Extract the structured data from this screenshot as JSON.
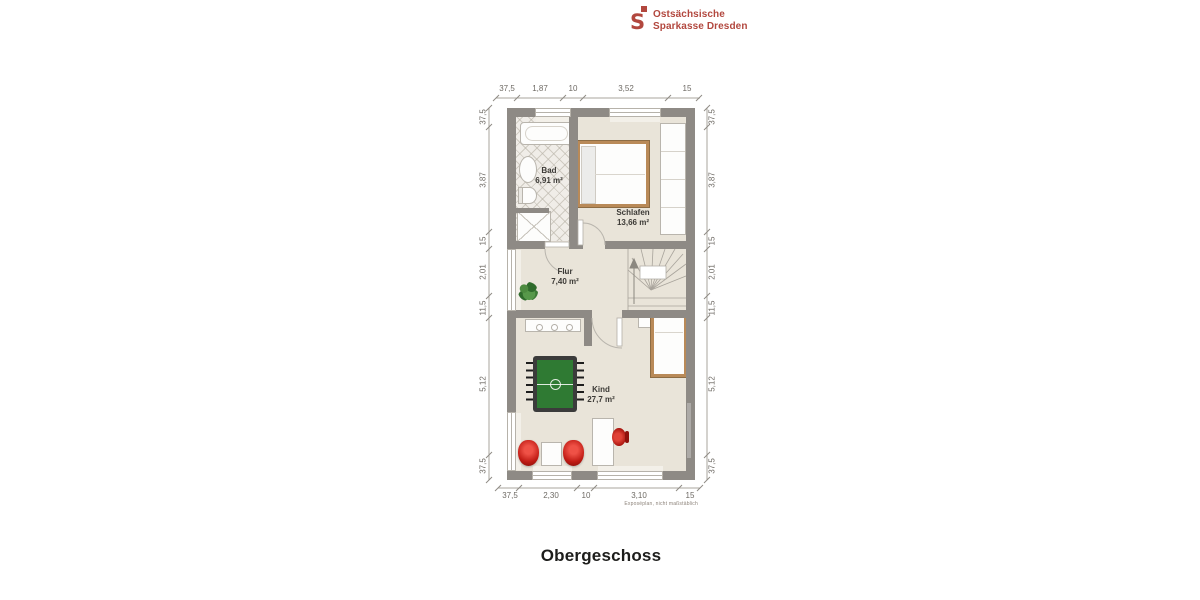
{
  "logo": {
    "icon_letter": "S",
    "name_line1": "Ostsächsische",
    "name_line2": "Sparkasse Dresden"
  },
  "plan": {
    "title": "Obergeschoss",
    "disclaimer": "Exposéplan, nicht maßstäblich",
    "rooms": [
      {
        "name": "Bad",
        "area": "6,91 m²"
      },
      {
        "name": "Schlafen",
        "area": "13,66 m²"
      },
      {
        "name": "Flur",
        "area": "7,40 m²"
      },
      {
        "name": "Kind",
        "area": "27,7 m²"
      }
    ],
    "dimensions": {
      "top": [
        "37,5",
        "1,87",
        "10",
        "3,52",
        "15"
      ],
      "bottom": [
        "37,5",
        "2,30",
        "10",
        "3,10",
        "15"
      ],
      "left": [
        "37,5",
        "3,87",
        "15",
        "2,01",
        "11,5",
        "5,12",
        "37,5"
      ],
      "right": [
        "37,5",
        "3,87",
        "15",
        "2,01",
        "11,5",
        "5,12",
        "37,5"
      ]
    },
    "colors": {
      "brand_red": "#b2473e",
      "wall": "#8e8a85",
      "floor": "#e9e4d9",
      "tile": "#f0ede8",
      "wood": "#b98a58",
      "accent_red": "#c01b14",
      "field_green": "#2f7a33"
    }
  }
}
